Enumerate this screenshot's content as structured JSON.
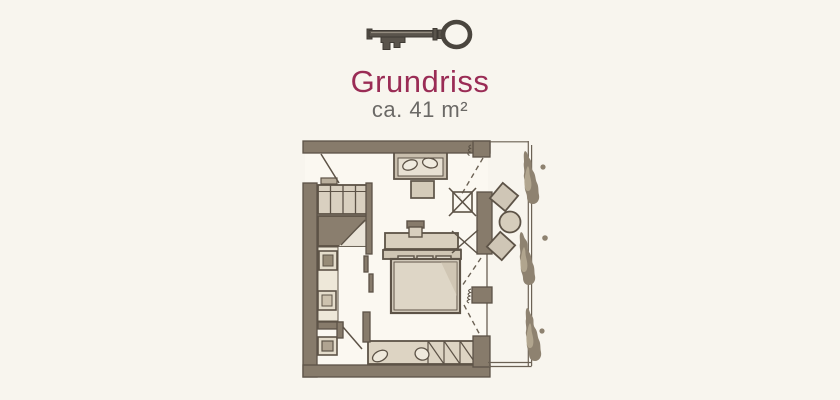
{
  "page": {
    "background_color": "#f8f5ee"
  },
  "header": {
    "key_icon": "antique-key-icon",
    "title": "Grundriss",
    "subtitle": "ca. 41 m²",
    "title_color": "#9a2c55",
    "subtitle_color": "#6b6966"
  },
  "colors": {
    "wall": "#877b6b",
    "ink": "#5d5347",
    "furniture_fill": "#d9d0c0",
    "furniture_light": "#ece6d9",
    "plant": "#8e8270",
    "key": "#4a453e"
  },
  "floorplan": {
    "kind": "hand-drawn room floor plan sketch",
    "elements": [
      "entrance-door",
      "wardrobe",
      "shower",
      "washbasin",
      "wall-niche",
      "toilet",
      "bathroom-door",
      "sofa",
      "coffee-table",
      "desk",
      "desk-chair",
      "crossed-chair-mark",
      "bed",
      "pillows",
      "bench-with-hatching",
      "slippers",
      "window-piers",
      "balcony-door",
      "window-swing-lines",
      "balcony-chairs",
      "balcony-round-table",
      "balcony-railing",
      "plants"
    ]
  }
}
